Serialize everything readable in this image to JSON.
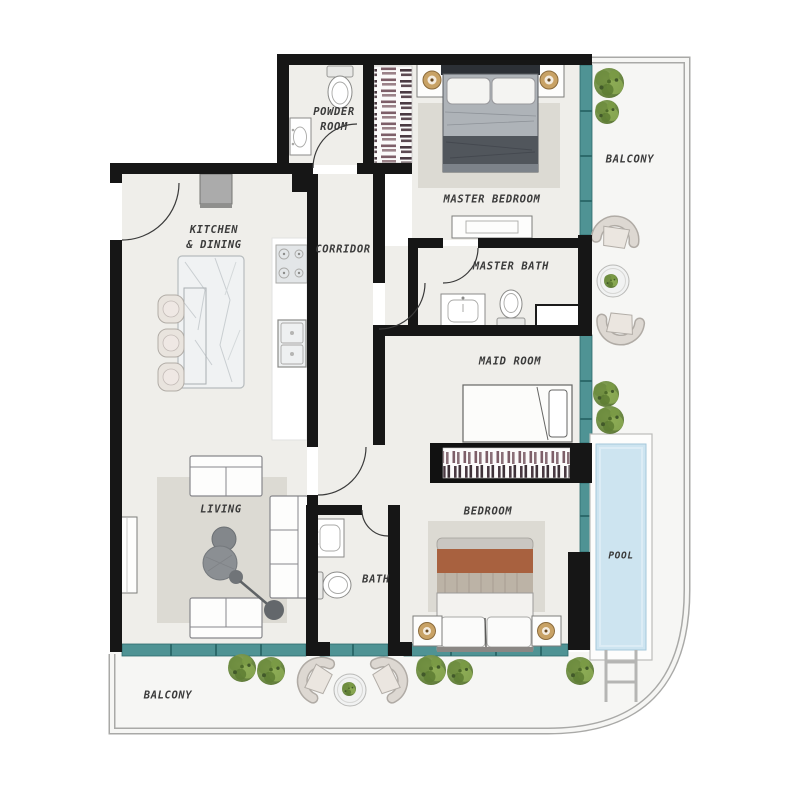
{
  "rooms": {
    "powder_room": {
      "label": "POWDER\nROOM"
    },
    "master_bedroom": {
      "label": "MASTER BEDROOM"
    },
    "balcony_right": {
      "label": "BALCONY"
    },
    "kitchen_dining": {
      "label": "KITCHEN\n& DINING"
    },
    "corridor": {
      "label": "CORRIDOR"
    },
    "master_bath": {
      "label": "MASTER BATH"
    },
    "maid_room": {
      "label": "MAID ROOM"
    },
    "living": {
      "label": "LIVING"
    },
    "bath": {
      "label": "BATH"
    },
    "bedroom": {
      "label": "BEDROOM"
    },
    "pool": {
      "label": "POOL"
    },
    "balcony_bottom": {
      "label": "BALCONY"
    }
  },
  "colors": {
    "wall": "#161616",
    "glazing": "#4f9394",
    "glazingDark": "#2c6a6b",
    "floor": "#efeeea",
    "balconyFloor": "#f6f6f4",
    "rug": "#dcdad3",
    "poolWater": "#cde4f0",
    "poolDeck": "#fdfdfc",
    "plantGreen": "#74924a",
    "label": "#3b3b3b",
    "blanketMaster": "#51565c",
    "blanketBedroom": "#a8613f",
    "furnitureCream": "#e9e4de"
  }
}
